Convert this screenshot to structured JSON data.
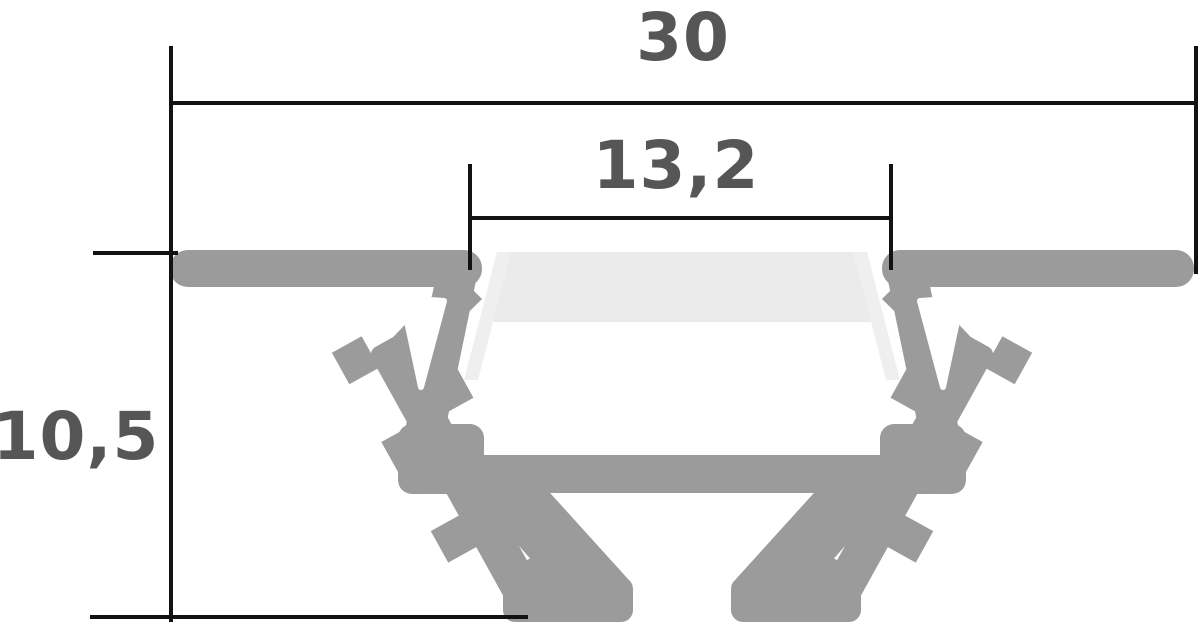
{
  "diagram": {
    "dimensions": {
      "overall_width": "30",
      "opening_width": "13,2",
      "overall_height": "10,5"
    },
    "colors": {
      "profile": "#9b9b9b",
      "diffuser": "#ebebeb",
      "diffuser_edge": "#efefef",
      "dimension_line": "#121212",
      "label": "#565656",
      "background": "#ffffff"
    }
  }
}
